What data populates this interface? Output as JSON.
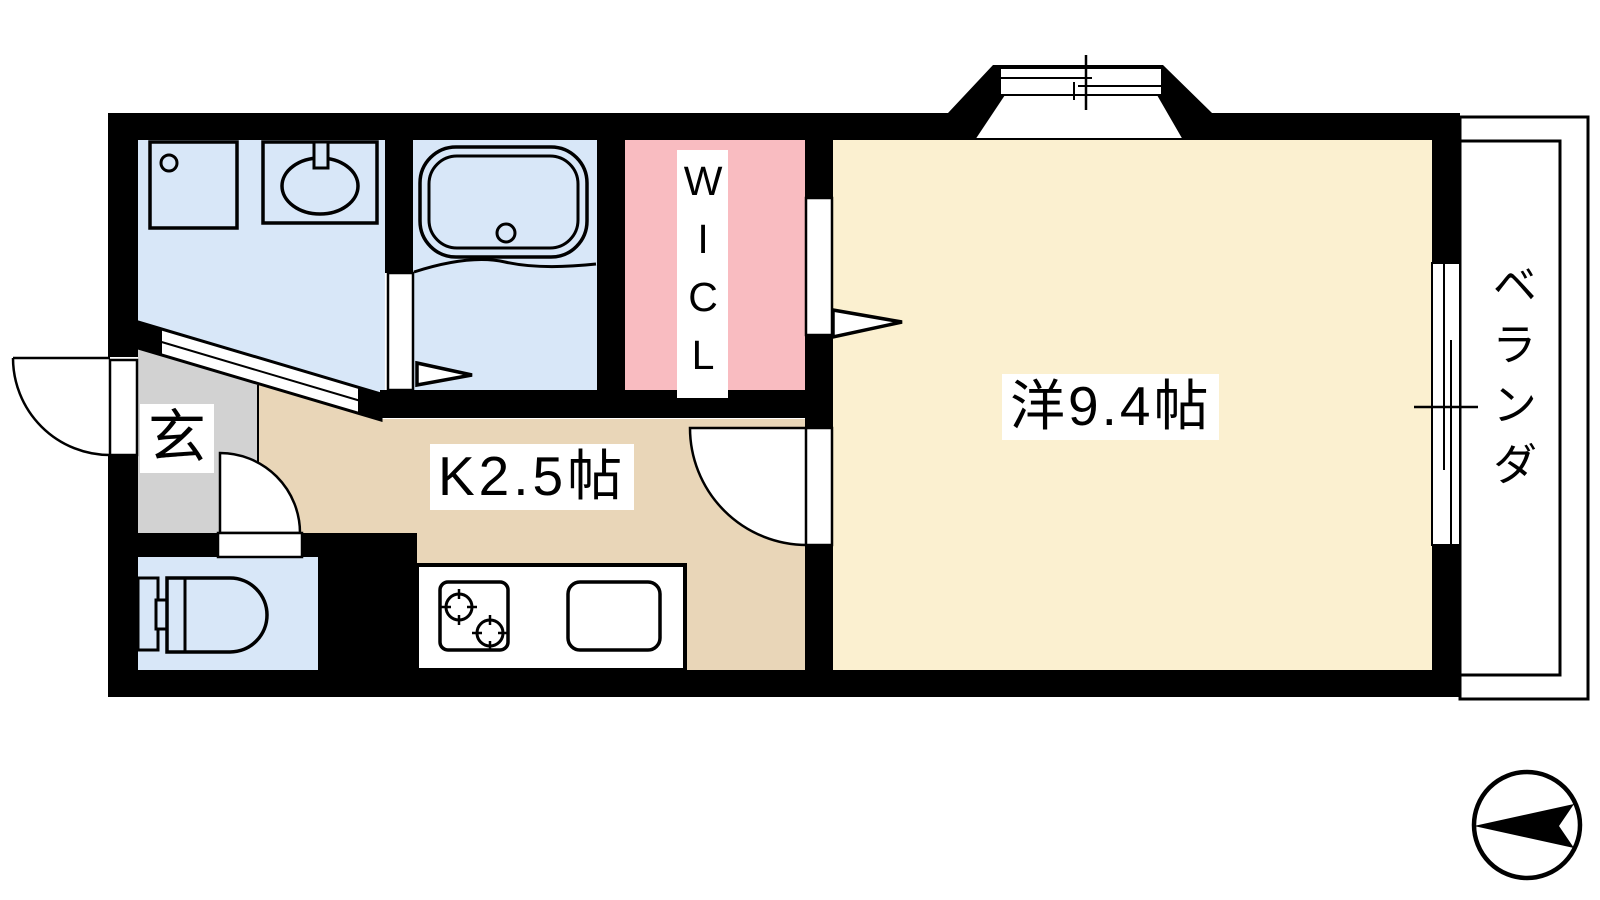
{
  "rooms": {
    "western_room": {
      "label": "洋9.4帖",
      "floor_color": "#fbf0d0"
    },
    "kitchen": {
      "label": "K2.5帖",
      "floor_color": "#e9d6b8"
    },
    "walk_in_closet": {
      "label": "WICL",
      "floor_color": "#f9bcc1"
    },
    "entrance": {
      "label": "玄",
      "floor_color": "#d2d2d2"
    },
    "veranda": {
      "label": "ベランダ",
      "floor_color": "#ffffff"
    },
    "washroom": {
      "floor_color": "#d8e7f8"
    },
    "bathroom": {
      "floor_color": "#d8e7f8"
    },
    "toilet": {
      "floor_color": "#d8e7f8"
    }
  },
  "colors": {
    "wall": "#000000",
    "line": "#000000",
    "label_background": "#ffffff",
    "background": "#ffffff"
  },
  "icons": {
    "compass": "circle-with-left-pointing-arrow",
    "fixtures": [
      "bathtub",
      "washbasin",
      "washer-pan",
      "toilet",
      "two-burner-stove",
      "kitchen-sink",
      "bay-window",
      "sliding-door",
      "hinged-door",
      "folding-door"
    ]
  }
}
